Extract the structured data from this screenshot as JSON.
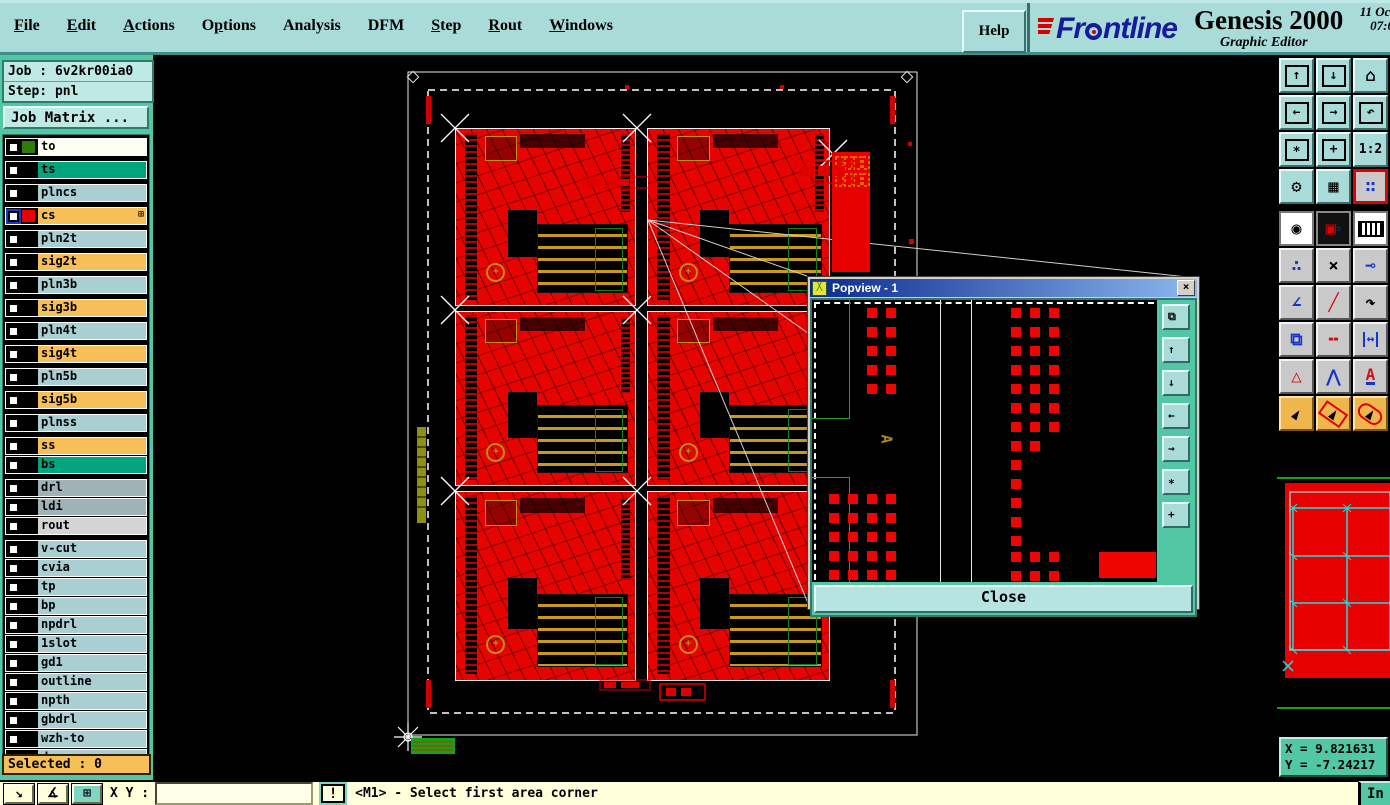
{
  "menubar": {
    "items": [
      {
        "label": "File",
        "u": 0
      },
      {
        "label": "Edit",
        "u": 0
      },
      {
        "label": "Actions",
        "u": 0
      },
      {
        "label": "Options",
        "u": 1
      },
      {
        "label": "Analysis",
        "u": -1
      },
      {
        "label": "DFM",
        "u": -1
      },
      {
        "label": "Step",
        "u": 0
      },
      {
        "label": "Rout",
        "u": 0
      },
      {
        "label": "Windows",
        "u": 0
      }
    ],
    "help_label": "Help"
  },
  "brand": {
    "name": "Frontline",
    "logo_left": "Fr",
    "logo_right": "ntline",
    "product": "Genesis 2000",
    "subtitle": "Graphic Editor",
    "date": "11 Oct",
    "time": "07:0"
  },
  "job": {
    "job_label": "Job : 6v2kr00ia0",
    "step_label": "Step: pnl",
    "matrix_label": "Job Matrix ..."
  },
  "layers": {
    "selected_label": "Selected : 0",
    "items": [
      {
        "name": "to",
        "bg": "white",
        "chip": "#2e7d0a",
        "gap": true
      },
      {
        "name": "ts",
        "bg": "green",
        "chip": "#000000",
        "gap": true
      },
      {
        "name": "plncs",
        "bg": "blue",
        "chip": "#000000",
        "gap": true
      },
      {
        "name": "cs",
        "bg": "orange",
        "chip": "#e60000",
        "gap": true,
        "active": true,
        "grid_glyph": "⊞"
      },
      {
        "name": "pln2t",
        "bg": "blue",
        "chip": "#000000",
        "gap": true
      },
      {
        "name": "sig2t",
        "bg": "orange",
        "chip": "#000000",
        "gap": true
      },
      {
        "name": "pln3b",
        "bg": "blue",
        "chip": "#000000",
        "gap": true
      },
      {
        "name": "sig3b",
        "bg": "orange",
        "chip": "#000000",
        "gap": true
      },
      {
        "name": "pln4t",
        "bg": "blue",
        "chip": "#000000",
        "gap": true
      },
      {
        "name": "sig4t",
        "bg": "orange",
        "chip": "#000000",
        "gap": true
      },
      {
        "name": "pln5b",
        "bg": "blue",
        "chip": "#000000",
        "gap": true
      },
      {
        "name": "sig5b",
        "bg": "orange",
        "chip": "#000000",
        "gap": true
      },
      {
        "name": "plnss",
        "bg": "blue",
        "chip": "#000000",
        "gap": true
      },
      {
        "name": "ss",
        "bg": "orange",
        "chip": "#000000",
        "gap": false
      },
      {
        "name": "bs",
        "bg": "green",
        "chip": "#000000",
        "gap": true
      },
      {
        "name": "drl",
        "bg": "gray",
        "chip": "#000000",
        "gap": false
      },
      {
        "name": "ldi",
        "bg": "gray",
        "chip": "#000000",
        "gap": false
      },
      {
        "name": "rout",
        "bg": "lightgray",
        "chip": "#000000",
        "gap": true
      },
      {
        "name": "v-cut",
        "bg": "blue",
        "chip": "#000000",
        "gap": false
      },
      {
        "name": "cvia",
        "bg": "blue",
        "chip": "#000000",
        "gap": false
      },
      {
        "name": "tp",
        "bg": "blue",
        "chip": "#000000",
        "gap": false
      },
      {
        "name": "bp",
        "bg": "blue",
        "chip": "#000000",
        "gap": false
      },
      {
        "name": "npdrl",
        "bg": "blue",
        "chip": "#000000",
        "gap": false
      },
      {
        "name": "1slot",
        "bg": "blue",
        "chip": "#000000",
        "gap": false
      },
      {
        "name": "gd1",
        "bg": "blue",
        "chip": "#000000",
        "gap": false
      },
      {
        "name": "outline",
        "bg": "blue",
        "chip": "#000000",
        "gap": false
      },
      {
        "name": "npth",
        "bg": "blue",
        "chip": "#000000",
        "gap": false
      },
      {
        "name": "gbdrl",
        "bg": "blue",
        "chip": "#000000",
        "gap": false
      },
      {
        "name": "wzh-to",
        "bg": "blue",
        "chip": "#000000",
        "gap": false
      },
      {
        "name": "d",
        "bg": "blue",
        "chip": "#000000",
        "gap": false
      }
    ]
  },
  "toolbar": {
    "buttons": [
      {
        "name": "zoom-window-in-icon",
        "style": "t-teal",
        "kind": "boxarrow",
        "glyph": "↑"
      },
      {
        "name": "zoom-window-out-icon",
        "style": "t-teal",
        "kind": "boxarrow",
        "glyph": "↓"
      },
      {
        "name": "home-view-icon",
        "style": "t-teal",
        "kind": "plain",
        "glyph": "⌂"
      },
      {
        "name": "pan-left-icon",
        "style": "t-teal",
        "kind": "boxarrow",
        "glyph": "←"
      },
      {
        "name": "pan-right-icon",
        "style": "t-teal",
        "kind": "boxarrow",
        "glyph": "→"
      },
      {
        "name": "previous-view-icon",
        "style": "t-teal",
        "kind": "boxarrow",
        "glyph": "↶"
      },
      {
        "name": "zoom-fit-icon",
        "style": "t-teal",
        "kind": "boxarrow",
        "glyph": "∗"
      },
      {
        "name": "zoom-center-icon",
        "style": "t-teal",
        "kind": "boxarrow",
        "glyph": "+"
      },
      {
        "name": "zoom-ratio-button",
        "style": "t-teal",
        "kind": "text",
        "glyph": "1:2"
      },
      {
        "name": "setup-tools-icon",
        "style": "t-teal",
        "kind": "plain",
        "glyph": "⚙"
      },
      {
        "name": "grid-toggle-icon",
        "style": "t-teal",
        "kind": "plain",
        "glyph": "▦"
      },
      {
        "name": "net-highlight-icon",
        "style": "t-hl",
        "kind": "netdots",
        "glyph": "∷"
      },
      {
        "name": "select-point-icon",
        "style": "t-white",
        "kind": "plain",
        "glyph": "◉"
      },
      {
        "name": "transform-shape-icon",
        "style": "t-black",
        "kind": "transform",
        "glyph": "▣"
      },
      {
        "name": "ruler-icon",
        "style": "t-white",
        "kind": "ruler",
        "glyph": ""
      },
      {
        "name": "connect-dots-icon",
        "style": "t-gray",
        "kind": "blue",
        "glyph": "∴"
      },
      {
        "name": "delete-cross-icon",
        "style": "t-gray",
        "kind": "plain",
        "glyph": "×"
      },
      {
        "name": "grow-pad-icon",
        "style": "t-gray",
        "kind": "blue",
        "glyph": "⊸"
      },
      {
        "name": "angle-measure-icon",
        "style": "t-gray",
        "kind": "blue",
        "glyph": "∠"
      },
      {
        "name": "line-draw-icon",
        "style": "t-gray",
        "kind": "red",
        "glyph": "╱"
      },
      {
        "name": "arc-draw-icon",
        "style": "t-gray",
        "kind": "plain",
        "glyph": "↷"
      },
      {
        "name": "copy-pad-icon",
        "style": "t-gray",
        "kind": "blue",
        "glyph": "⧉"
      },
      {
        "name": "break-line-icon",
        "style": "t-gray",
        "kind": "red",
        "glyph": "╍"
      },
      {
        "name": "measure-width-icon",
        "style": "t-gray",
        "kind": "measure",
        "glyph": "↔"
      },
      {
        "name": "text-small-icon",
        "style": "t-gray",
        "kind": "red",
        "glyph": "△"
      },
      {
        "name": "text-medium-icon",
        "style": "t-gray",
        "kind": "blue",
        "glyph": "⋀"
      },
      {
        "name": "text-large-icon",
        "style": "t-gray",
        "kind": "aunder",
        "glyph": "A"
      },
      {
        "name": "cursor-select-icon",
        "style": "t-orange",
        "kind": "cursor",
        "glyph": "►"
      },
      {
        "name": "cursor-frame-icon",
        "style": "t-orange",
        "kind": "cursorframe",
        "glyph": "►"
      },
      {
        "name": "cursor-round-icon",
        "style": "t-orange",
        "kind": "cursorround",
        "glyph": "►"
      }
    ]
  },
  "popview": {
    "title": "Popview - 1",
    "close_label": "Close",
    "marker": "A",
    "side_buttons": [
      {
        "name": "popview-window-icon",
        "glyph": "⧉"
      },
      {
        "name": "popview-zoom-in-icon",
        "glyph": "↑"
      },
      {
        "name": "popview-zoom-out-icon",
        "glyph": "↓"
      },
      {
        "name": "popview-pan-left-icon",
        "glyph": "←"
      },
      {
        "name": "popview-pan-right-icon",
        "glyph": "→"
      },
      {
        "name": "popview-fit-icon",
        "glyph": "∗"
      },
      {
        "name": "popview-center-icon",
        "glyph": "+"
      }
    ],
    "pad_groups": [
      {
        "x": 55,
        "y": 8,
        "cols": 2,
        "rows": 5,
        "dx": 19,
        "dy": 19,
        "size": 10
      },
      {
        "x": 17,
        "y": 194,
        "cols": 4,
        "rows": 5,
        "dx": 19,
        "dy": 19,
        "size": 10
      },
      {
        "x": 199,
        "y": 8,
        "cols": 3,
        "rows": 5,
        "dx": 19,
        "dy": 19,
        "size": 10
      },
      {
        "x": 199,
        "y": 103,
        "cols": 3,
        "rows": 2,
        "dx": 19,
        "dy": 19,
        "size": 10
      },
      {
        "x": 199,
        "y": 141,
        "cols": 2,
        "rows": 1,
        "dx": 19,
        "dy": 19,
        "size": 10
      },
      {
        "x": 199,
        "y": 160,
        "cols": 1,
        "rows": 5,
        "dx": 19,
        "dy": 19,
        "size": 10
      },
      {
        "x": 199,
        "y": 252,
        "cols": 3,
        "rows": 2,
        "dx": 19,
        "dy": 19,
        "size": 10
      }
    ],
    "pad_rect": {
      "x": 287,
      "y": 252,
      "w": 57,
      "h": 26
    }
  },
  "statusbar": {
    "xy_label": "X Y :",
    "input_value": "",
    "alert_label": "!",
    "message": "<M1> - Select first area corner",
    "units_label": "In"
  },
  "coords": {
    "x_label": "X = 9.821631",
    "y_label": "Y = -7.24217"
  }
}
